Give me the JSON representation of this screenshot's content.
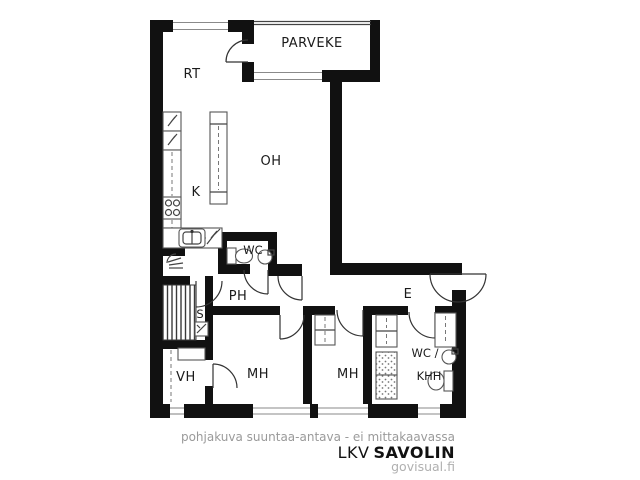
{
  "plan": {
    "rooms": {
      "parveke": "PARVEKE",
      "rt": "RT",
      "oh": "OH",
      "k": "K",
      "wc": "WC",
      "ph": "PH",
      "s": "S",
      "e": "E",
      "vh": "VH",
      "mh1": "MH",
      "mh2": "MH",
      "wc_khh_line1": "WC /",
      "wc_khh_line2": "KHH"
    },
    "colors": {
      "wall": "#111111",
      "fixture_line": "#555555",
      "window_line": "#8a8a8a",
      "label_text": "#1b1b1b"
    }
  },
  "footer": {
    "disclaimer": "pohjakuva suuntaa-antava - ei mittakaavassa",
    "brand_prefix": "LKV",
    "brand_name": "SAVOLIN",
    "website": "govisual.fi"
  }
}
